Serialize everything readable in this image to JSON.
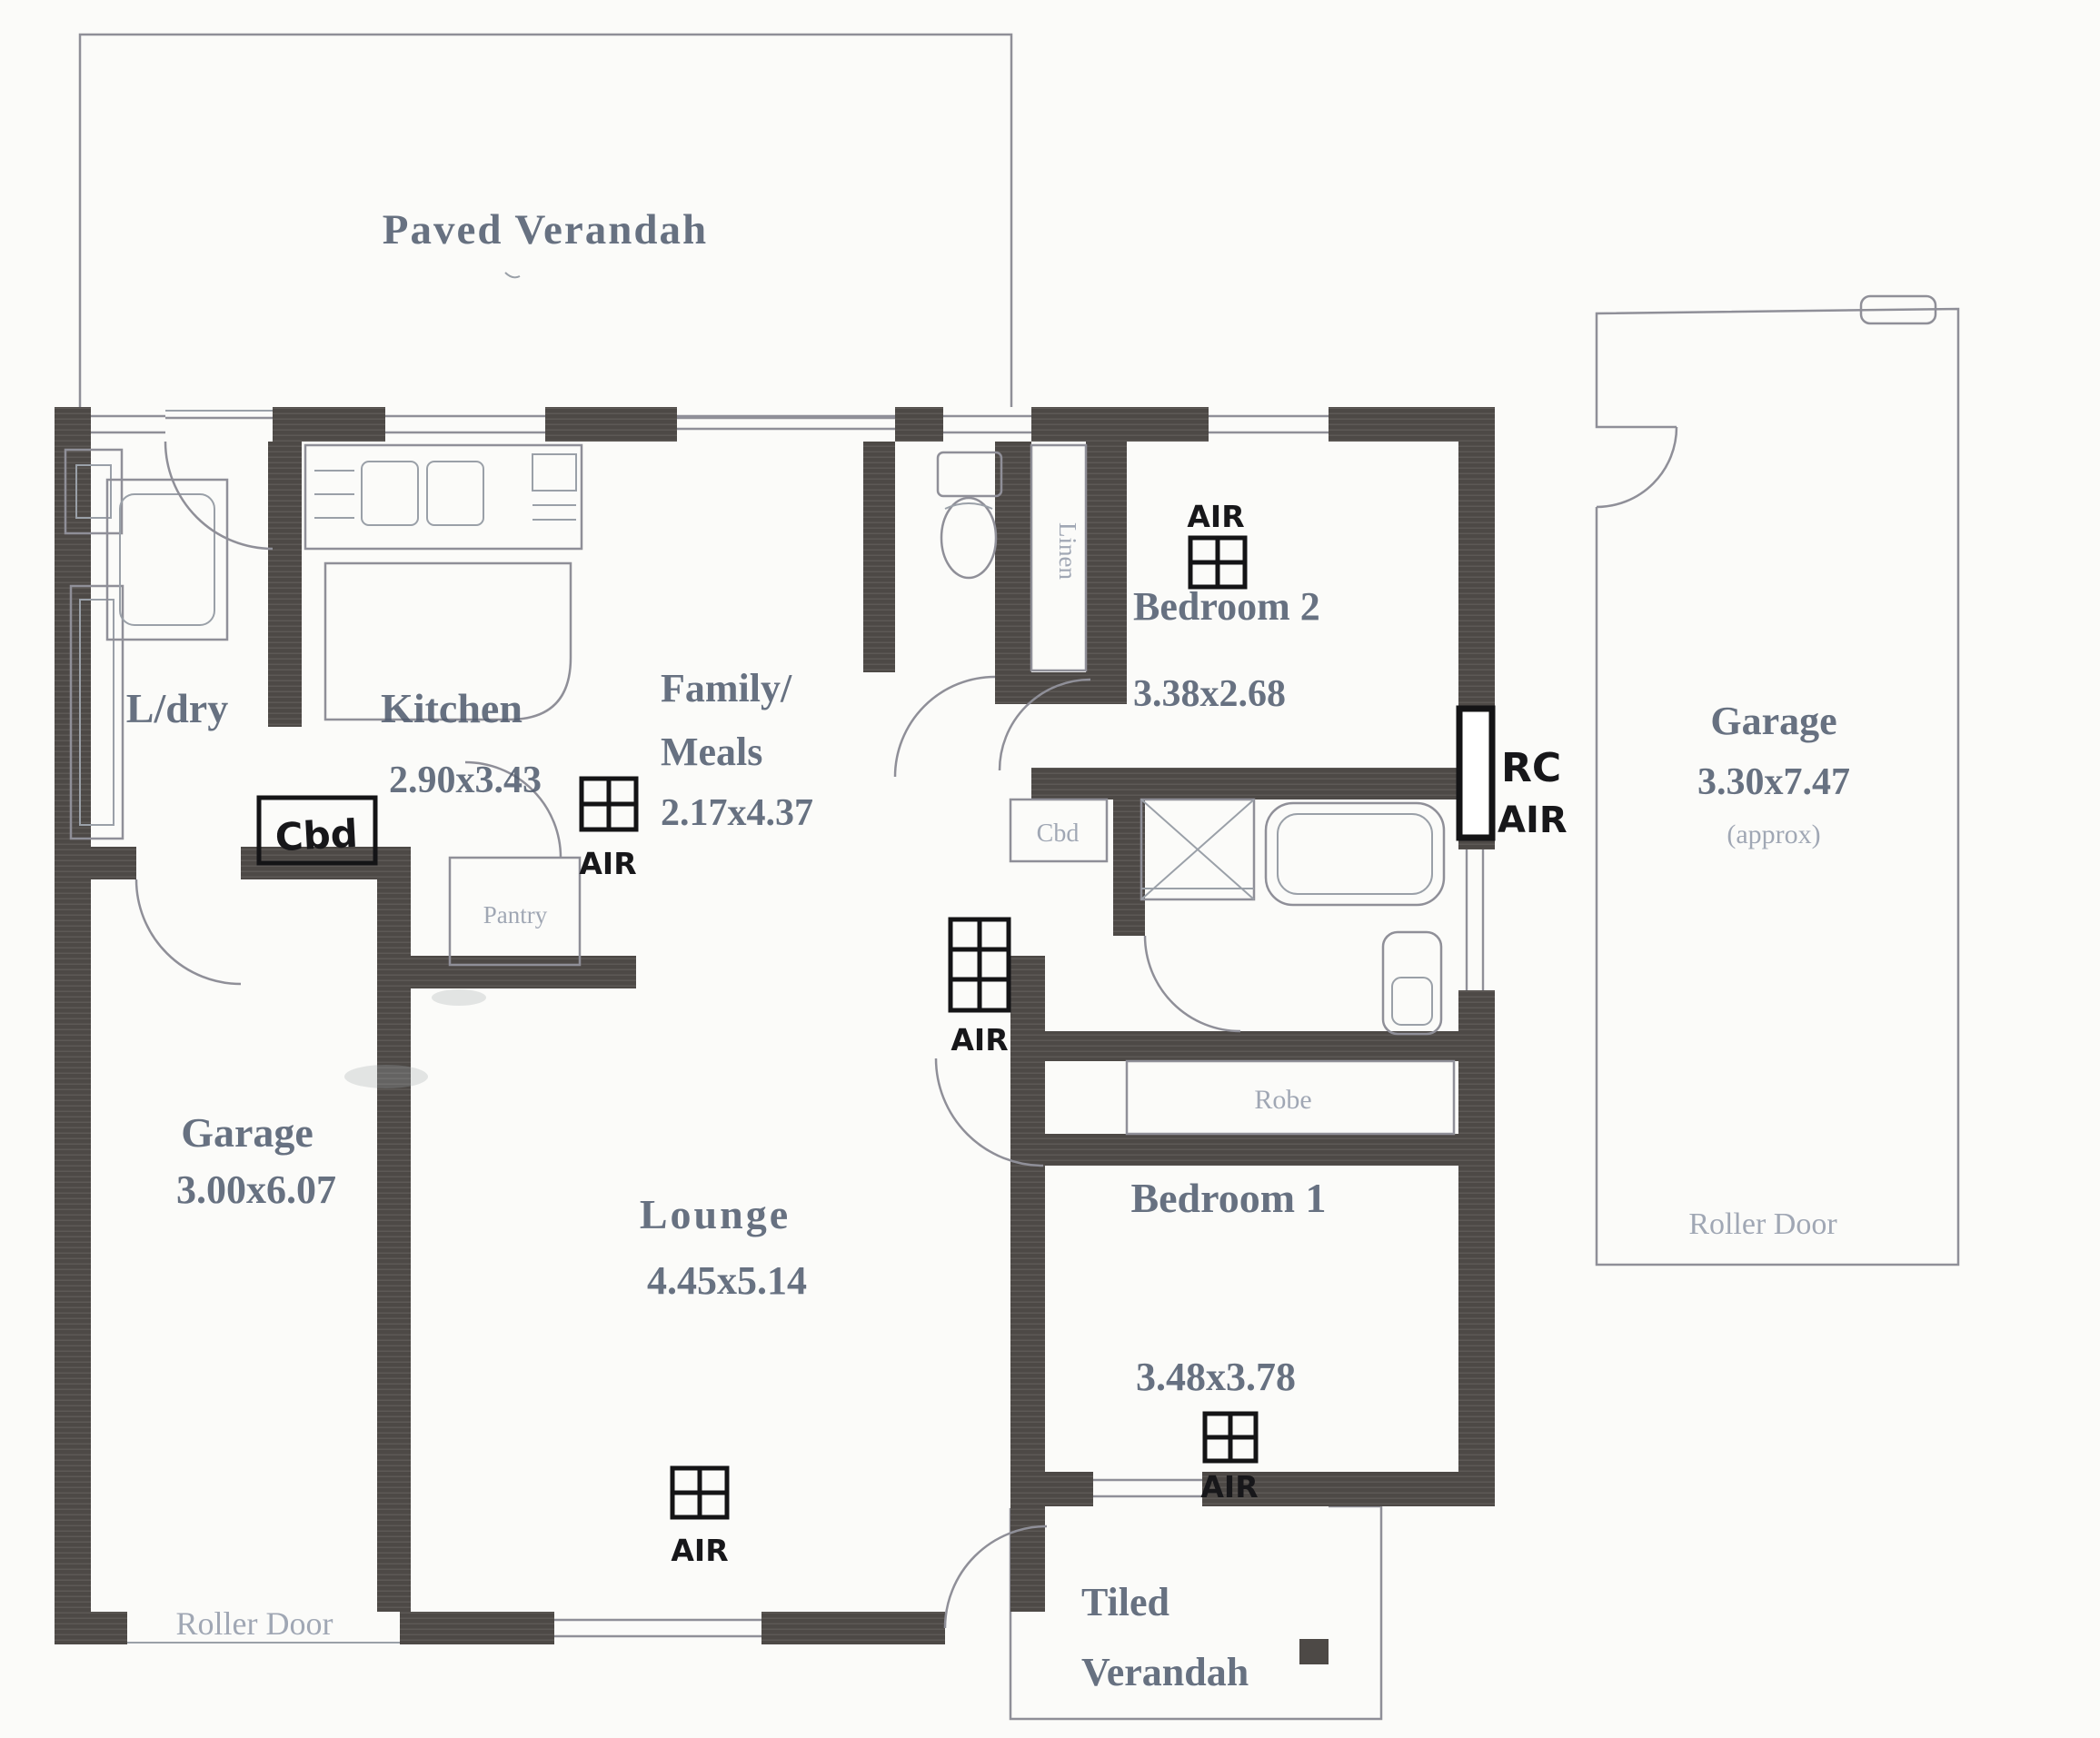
{
  "rooms": {
    "paved_verandah": {
      "label": "Paved Verandah"
    },
    "ldry": {
      "label": "L/dry"
    },
    "kitchen": {
      "label": "Kitchen",
      "dims": "2.90x3.43"
    },
    "family": {
      "line1": "Family/",
      "line2": "Meals",
      "dims": "2.17x4.37"
    },
    "bedroom2": {
      "label": "Bedroom 2",
      "dims": "3.38x2.68"
    },
    "garage_right": {
      "label": "Garage",
      "dims": "3.30x7.47",
      "note": "(approx)",
      "roller_door": "Roller Door"
    },
    "garage_left": {
      "label": "Garage",
      "dims": "3.00x6.07",
      "roller_door": "Roller Door"
    },
    "lounge": {
      "label": "Lounge",
      "dims": "4.45x5.14"
    },
    "bedroom1": {
      "label": "Bedroom 1",
      "dims": "3.48x3.78"
    },
    "tiled_verandah": {
      "line1": "Tiled",
      "line2": "Verandah"
    }
  },
  "closets": {
    "cbd_hall": "Cbd",
    "cbd_bath": "Cbd",
    "pantry": "Pantry",
    "linen": "Linen",
    "robe": "Robe"
  },
  "annotations": {
    "air": "AIR",
    "rc": "RC",
    "rc_air": "AIR"
  },
  "colors": {
    "wall": "#4d4946",
    "pencil": "#8f8f98",
    "label": "#4e5a6d",
    "faint": "#8a93a4",
    "ink": "#17171a",
    "paper": "#fbfbf9"
  }
}
